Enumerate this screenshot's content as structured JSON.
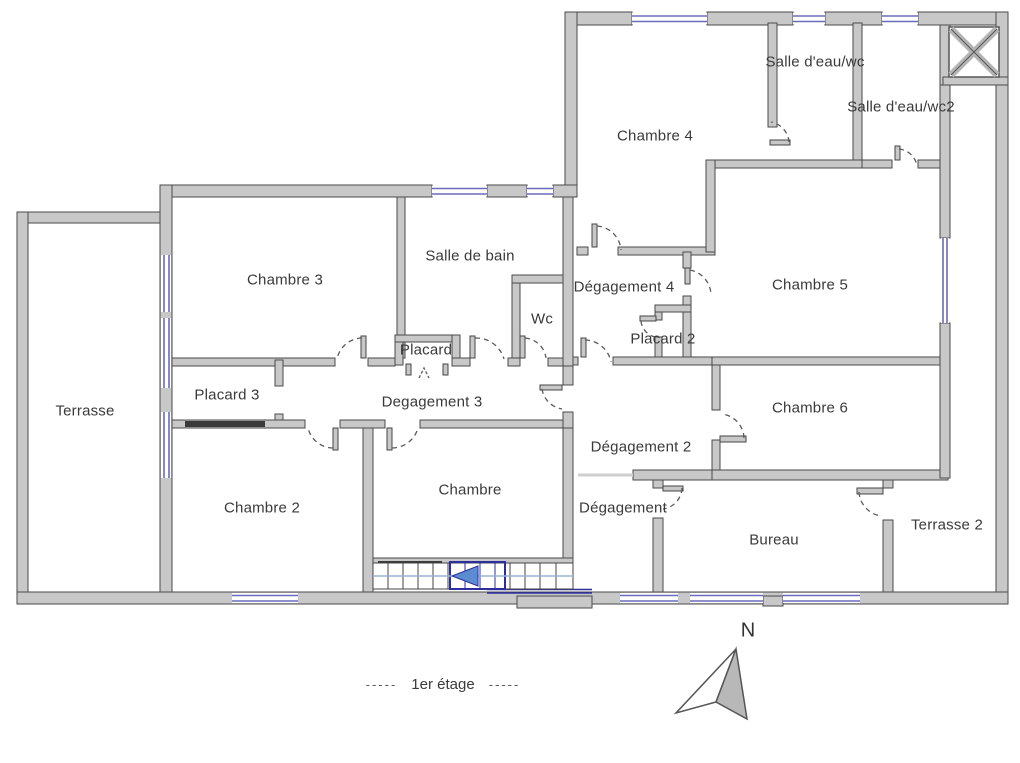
{
  "plan": {
    "floor_caption": "1er étage",
    "caption_dashes": "-----",
    "compass_label": "N"
  },
  "rooms": [
    {
      "id": "terrasse",
      "label": "Terrasse",
      "x": 85,
      "y": 411
    },
    {
      "id": "chambre-3",
      "label": "Chambre 3",
      "x": 285,
      "y": 280
    },
    {
      "id": "salle-de-bain",
      "label": "Salle de bain",
      "x": 470,
      "y": 256
    },
    {
      "id": "chambre-4",
      "label": "Chambre 4",
      "x": 655,
      "y": 136
    },
    {
      "id": "salle-eau-wc",
      "label": "Salle d'eau/wc",
      "x": 815,
      "y": 62
    },
    {
      "id": "salle-eau-wc2",
      "label": "Salle d'eau/wc2",
      "x": 901,
      "y": 107
    },
    {
      "id": "chambre-5",
      "label": "Chambre 5",
      "x": 810,
      "y": 285
    },
    {
      "id": "degagement-4",
      "label": "Dégagement 4",
      "x": 624,
      "y": 287
    },
    {
      "id": "wc",
      "label": "Wc",
      "x": 542,
      "y": 319
    },
    {
      "id": "placard",
      "label": "Placard",
      "x": 426,
      "y": 350
    },
    {
      "id": "placard-2",
      "label": "Placard 2",
      "x": 663,
      "y": 339
    },
    {
      "id": "placard-3",
      "label": "Placard 3",
      "x": 227,
      "y": 395
    },
    {
      "id": "degagement-3",
      "label": "Degagement 3",
      "x": 432,
      "y": 402
    },
    {
      "id": "chambre-6",
      "label": "Chambre 6",
      "x": 810,
      "y": 408
    },
    {
      "id": "degagement-2",
      "label": "Dégagement 2",
      "x": 641,
      "y": 447
    },
    {
      "id": "chambre-2",
      "label": "Chambre 2",
      "x": 262,
      "y": 508
    },
    {
      "id": "chambre",
      "label": "Chambre",
      "x": 470,
      "y": 490
    },
    {
      "id": "degagement",
      "label": "Dégagement",
      "x": 623,
      "y": 508
    },
    {
      "id": "bureau",
      "label": "Bureau",
      "x": 774,
      "y": 540
    },
    {
      "id": "terrasse-2",
      "label": "Terrasse 2",
      "x": 947,
      "y": 525
    }
  ],
  "colors": {
    "wall": "#c8c8c8",
    "wall_outline": "#4a4a4a",
    "window": "#6b6bbb",
    "stair_accent": "#2d2da0",
    "stair_arrow": "#5b8bd0",
    "text": "#3a3a3a"
  }
}
